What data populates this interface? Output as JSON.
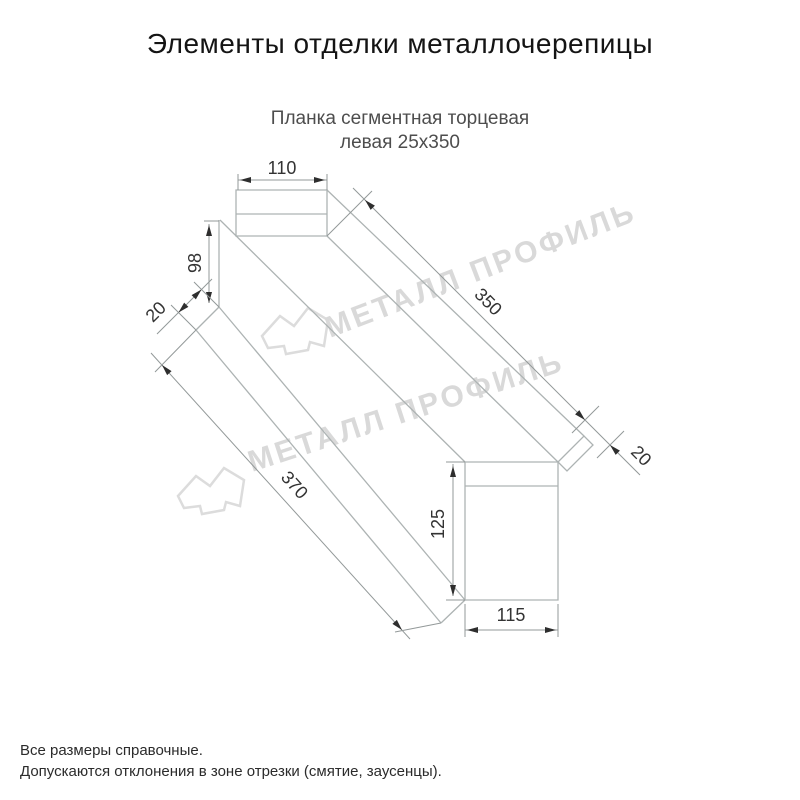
{
  "page": {
    "title": "Элементы отделки металлочерепицы",
    "subtitle_line1": "Планка сегментная торцевая",
    "subtitle_line2": "левая 25x350",
    "footer_line1": "Все размеры справочные.",
    "footer_line2": "Допускаются отклонения в зоне отрезки (смятие, заусенцы)."
  },
  "watermark": {
    "text": "МЕТАЛЛ ПРОФИЛЬ"
  },
  "dimensions": {
    "top_flange_width": "110",
    "near_end_height": "98",
    "near_hem": "20",
    "top_edge_length": "350",
    "end_hem": "20",
    "bottom_edge_length": "370",
    "end_face_height": "125",
    "end_face_width": "115"
  },
  "colors": {
    "background": "#ffffff",
    "title_text": "#141414",
    "subtitle_text": "#4d4d4d",
    "dimension_text": "#333333",
    "drawing_line": "#adb3b3",
    "dimension_line": "#939999",
    "arrowhead": "#2e2e2e",
    "watermark": "#d9d9d9",
    "footer_text": "#2b2b2b"
  }
}
